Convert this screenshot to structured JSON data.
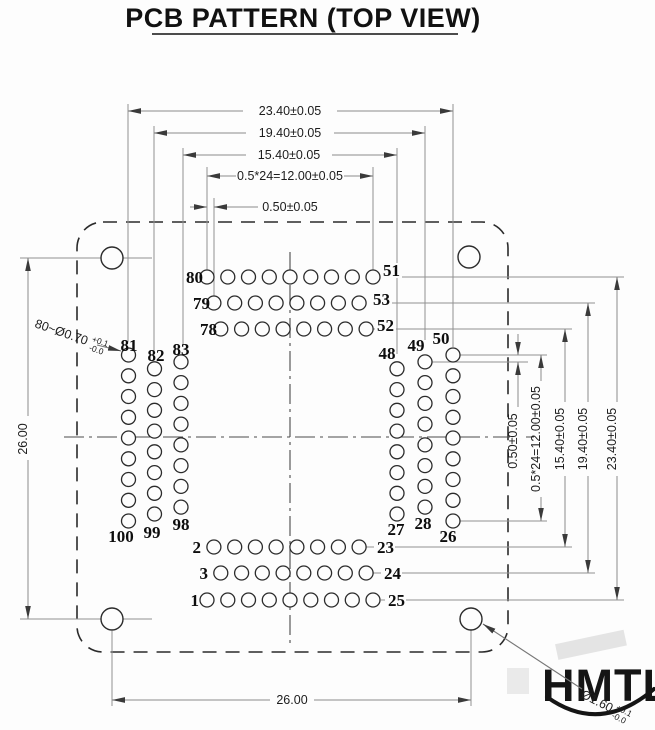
{
  "header": {
    "title": "PCB PATTERN  (TOP VIEW)"
  },
  "dims": {
    "top_23": "23.40±0.05",
    "top_19": "19.40±0.05",
    "top_15": "15.40±0.05",
    "top_12": "0.5*24=12.00±0.05",
    "top_05": "0.50±0.05",
    "right_23": "23.40±0.05",
    "right_19": "19.40±0.05",
    "right_15": "15.40±0.05",
    "right_12": "0.5*24=12.00±0.05",
    "right_05": "0.50±0.05",
    "left_26": "26.00",
    "bottom_26": "26.00"
  },
  "callouts": {
    "pad_spec": "80~Ø0.70",
    "pad_tol_plus": "+0.1",
    "pad_tol_minus": "-0.0",
    "mount_spec": "Ø1.60",
    "mount_tol_plus": "+0.1",
    "mount_tol_minus": "-0.0"
  },
  "pins": {
    "t80": "80",
    "t79": "79",
    "t78": "78",
    "t51": "51",
    "t53": "53",
    "t52": "52",
    "l81": "81",
    "l82": "82",
    "l83": "83",
    "l100": "100",
    "l99": "99",
    "l98": "98",
    "r48": "48",
    "r49": "49",
    "r50": "50",
    "r27": "27",
    "r28": "28",
    "r26": "26",
    "b1": "1",
    "b2": "2",
    "b3": "3",
    "b23": "23",
    "b24": "24",
    "b25": "25"
  },
  "logo": {
    "text": "HMTL"
  },
  "geometry": {
    "pad_radius": 7,
    "mount_hole_radius": 11,
    "pad_groups": [
      {
        "name": "top-outer",
        "x": 207,
        "y": 277,
        "dx": 20.75,
        "dy": 0,
        "n": 9
      },
      {
        "name": "top-middle",
        "x": 213.9,
        "y": 303,
        "dx": 20.75,
        "dy": 0,
        "n": 8
      },
      {
        "name": "top-inner",
        "x": 220.8,
        "y": 329,
        "dx": 20.75,
        "dy": 0,
        "n": 8
      },
      {
        "name": "bottom-inner",
        "x": 213.9,
        "y": 547,
        "dx": 20.75,
        "dy": 0,
        "n": 8
      },
      {
        "name": "bottom-middle",
        "x": 220.8,
        "y": 573,
        "dx": 20.75,
        "dy": 0,
        "n": 8
      },
      {
        "name": "bottom-outer",
        "x": 207,
        "y": 600,
        "dx": 20.75,
        "dy": 0,
        "n": 9
      },
      {
        "name": "left-outer",
        "x": 128.5,
        "y": 355,
        "dx": 0,
        "dy": 20.75,
        "n": 9
      },
      {
        "name": "left-middle",
        "x": 154.5,
        "y": 368.8,
        "dx": 0,
        "dy": 20.75,
        "n": 8
      },
      {
        "name": "left-inner",
        "x": 181,
        "y": 361.9,
        "dx": 0,
        "dy": 20.75,
        "n": 8
      },
      {
        "name": "right-inner",
        "x": 397,
        "y": 368.8,
        "dx": 0,
        "dy": 20.75,
        "n": 8
      },
      {
        "name": "right-middle",
        "x": 425,
        "y": 361.9,
        "dx": 0,
        "dy": 20.75,
        "n": 8
      },
      {
        "name": "right-outer",
        "x": 453,
        "y": 355,
        "dx": 0,
        "dy": 20.75,
        "n": 9
      }
    ],
    "mount_holes": [
      {
        "x": 112,
        "y": 258
      },
      {
        "x": 469,
        "y": 257
      },
      {
        "x": 112,
        "y": 619
      },
      {
        "x": 471,
        "y": 619
      }
    ]
  }
}
